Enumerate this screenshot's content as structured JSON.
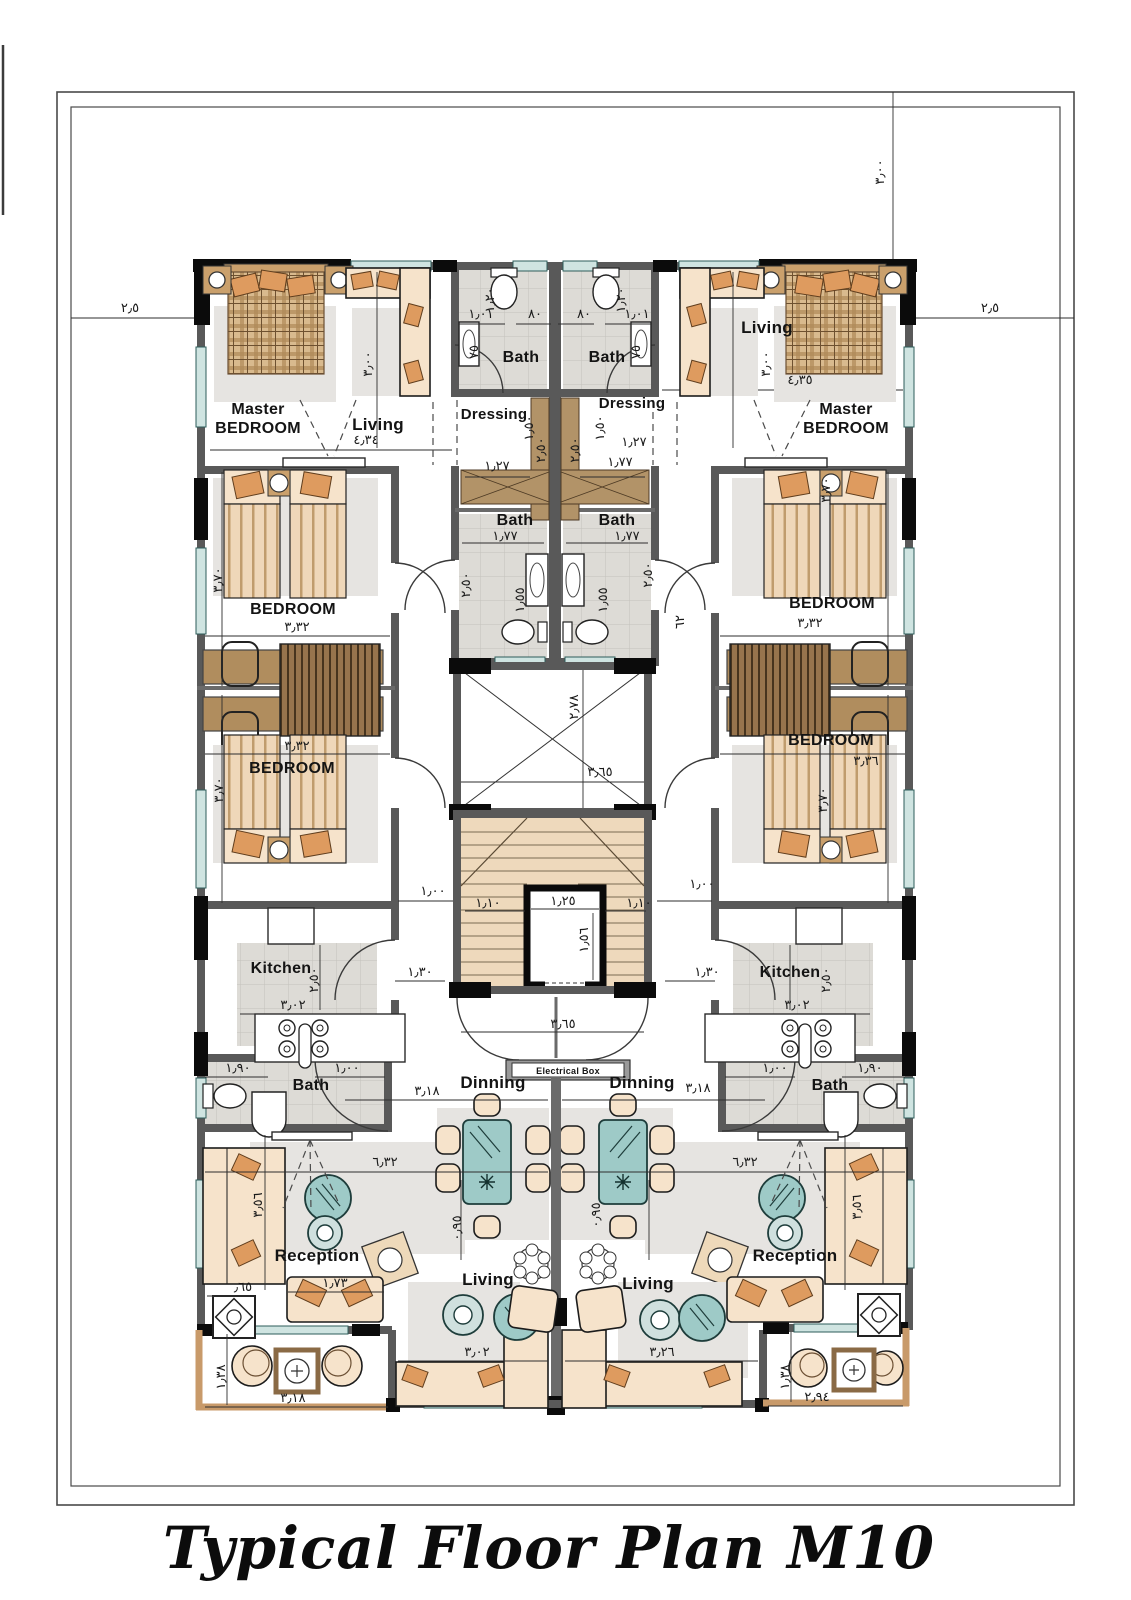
{
  "plan": {
    "title": "Typical Floor Plan M10",
    "colors": {
      "wall": "#595959",
      "column": "#0b0b0b",
      "window": "#cfe4e1",
      "furniture": "#f6e3cb",
      "cushion": "#de9b5f",
      "wood": "#b29368",
      "stair": "#eed9bc",
      "glass": "#9ecac7",
      "tile": "#dddbd6"
    },
    "room_labels": [
      {
        "id": "master-left-line1",
        "t": "Master",
        "x": 258,
        "y": 414,
        "s": 16
      },
      {
        "id": "master-left-line2",
        "t": "BEDROOM",
        "x": 258,
        "y": 433,
        "s": 16
      },
      {
        "id": "living-top-left",
        "t": "Living",
        "x": 378,
        "y": 430,
        "s": 17
      },
      {
        "id": "bath-top-left",
        "t": "Bath",
        "x": 521,
        "y": 362,
        "s": 16
      },
      {
        "id": "bath-top-right",
        "t": "Bath",
        "x": 607,
        "y": 362,
        "s": 16
      },
      {
        "id": "dressing-left",
        "t": "Dressing",
        "x": 494,
        "y": 419,
        "s": 15
      },
      {
        "id": "dressing-right",
        "t": "Dressing",
        "x": 632,
        "y": 408,
        "s": 15
      },
      {
        "id": "living-top-right",
        "t": "Living",
        "x": 767,
        "y": 333,
        "s": 17
      },
      {
        "id": "master-right-line1",
        "t": "Master",
        "x": 846,
        "y": 414,
        "s": 16
      },
      {
        "id": "master-right-line2",
        "t": "BEDROOM",
        "x": 846,
        "y": 433,
        "s": 16
      },
      {
        "id": "bath-mid-left",
        "t": "Bath",
        "x": 515,
        "y": 525,
        "s": 16
      },
      {
        "id": "bath-mid-right",
        "t": "Bath",
        "x": 617,
        "y": 525,
        "s": 16
      },
      {
        "id": "bedroom-left-1",
        "t": "BEDROOM",
        "x": 293,
        "y": 614,
        "s": 16
      },
      {
        "id": "bedroom-right-1",
        "t": "BEDROOM",
        "x": 832,
        "y": 608,
        "s": 16
      },
      {
        "id": "bedroom-left-2",
        "t": "BEDROOM",
        "x": 292,
        "y": 773,
        "s": 16
      },
      {
        "id": "bedroom-right-2",
        "t": "BEDROOM",
        "x": 831,
        "y": 745,
        "s": 16
      },
      {
        "id": "kitchen-left",
        "t": "Kitchen",
        "x": 281,
        "y": 973,
        "s": 16
      },
      {
        "id": "kitchen-right",
        "t": "Kitchen",
        "x": 790,
        "y": 977,
        "s": 16
      },
      {
        "id": "bath-bottom-left",
        "t": "Bath",
        "x": 311,
        "y": 1090,
        "s": 16
      },
      {
        "id": "bath-bottom-right",
        "t": "Bath",
        "x": 830,
        "y": 1090,
        "s": 16
      },
      {
        "id": "dinning-left",
        "t": "Dinning",
        "x": 493,
        "y": 1088,
        "s": 17
      },
      {
        "id": "dinning-right",
        "t": "Dinning",
        "x": 642,
        "y": 1088,
        "s": 17
      },
      {
        "id": "reception-left",
        "t": "Reception",
        "x": 317,
        "y": 1261,
        "s": 17
      },
      {
        "id": "reception-right",
        "t": "Reception",
        "x": 795,
        "y": 1261,
        "s": 17
      },
      {
        "id": "living-bottom-left",
        "t": "Living",
        "x": 488,
        "y": 1285,
        "s": 17
      },
      {
        "id": "living-bottom-right",
        "t": "Living",
        "x": 648,
        "y": 1289,
        "s": 17
      },
      {
        "id": "electrical-box",
        "t": "Electrical Box",
        "x": 568,
        "y": 1074,
        "s": 9
      }
    ],
    "dimensions": [
      {
        "t": "٢٫٥",
        "x": 130,
        "y": 312,
        "r": 0
      },
      {
        "t": "٢٫٥",
        "x": 990,
        "y": 312,
        "r": 0
      },
      {
        "t": "٣٫٠٠",
        "x": 884,
        "y": 172,
        "r": -90
      },
      {
        "t": "٤٫٣٤",
        "x": 366,
        "y": 444,
        "r": 0
      },
      {
        "t": "٤٫٣٥",
        "x": 800,
        "y": 384,
        "r": 0
      },
      {
        "t": "٣٫٠٠",
        "x": 372,
        "y": 364,
        "r": -90
      },
      {
        "t": "٣٫٠٠",
        "x": 770,
        "y": 364,
        "r": -90
      },
      {
        "t": "١٫٠١",
        "x": 481,
        "y": 318,
        "r": 0
      },
      {
        "t": "٨٠",
        "x": 535,
        "y": 318,
        "r": 0
      },
      {
        "t": "٨٠",
        "x": 584,
        "y": 318,
        "r": 0
      },
      {
        "t": "١٫٠١",
        "x": 637,
        "y": 318,
        "r": 0
      },
      {
        "t": "١٫٢٠",
        "x": 494,
        "y": 300,
        "r": -90
      },
      {
        "t": "١٫٢٠",
        "x": 625,
        "y": 300,
        "r": -90
      },
      {
        "t": "٧٥",
        "x": 478,
        "y": 352,
        "r": -90
      },
      {
        "t": "٧٥",
        "x": 640,
        "y": 352,
        "r": -90
      },
      {
        "t": "١٫٢٧",
        "x": 497,
        "y": 470,
        "r": 0
      },
      {
        "t": "١٫٢٧",
        "x": 634,
        "y": 446,
        "r": 0
      },
      {
        "t": "١٫٧٧",
        "x": 620,
        "y": 466,
        "r": 0
      },
      {
        "t": "١٫٥٠",
        "x": 533,
        "y": 428,
        "r": -90
      },
      {
        "t": "١٫٥٠",
        "x": 604,
        "y": 428,
        "r": -90
      },
      {
        "t": "٢٫٥٠",
        "x": 545,
        "y": 450,
        "r": -90
      },
      {
        "t": "٢٫٥٠",
        "x": 579,
        "y": 450,
        "r": -90
      },
      {
        "t": "١٫٧٧",
        "x": 505,
        "y": 540,
        "r": 0
      },
      {
        "t": "١٫٧٧",
        "x": 627,
        "y": 540,
        "r": 0
      },
      {
        "t": "١٫٥٥",
        "x": 524,
        "y": 600,
        "r": -90
      },
      {
        "t": "١٫٥٥",
        "x": 607,
        "y": 600,
        "r": -90
      },
      {
        "t": "٢٫٥٠",
        "x": 470,
        "y": 585,
        "r": -90
      },
      {
        "t": "٢٫٥٠",
        "x": 652,
        "y": 575,
        "r": -90
      },
      {
        "t": "٦٢",
        "x": 684,
        "y": 622,
        "r": -90
      },
      {
        "t": "٣٫٧٠",
        "x": 222,
        "y": 580,
        "r": -90
      },
      {
        "t": "٣٫٧٠",
        "x": 830,
        "y": 490,
        "r": -90
      },
      {
        "t": "٣٫٣٢",
        "x": 297,
        "y": 631,
        "r": 0
      },
      {
        "t": "٣٫٣٢",
        "x": 810,
        "y": 627,
        "r": 0
      },
      {
        "t": "٣٫٧٠",
        "x": 223,
        "y": 790,
        "r": -90
      },
      {
        "t": "٣٫٧٠",
        "x": 827,
        "y": 800,
        "r": -90
      },
      {
        "t": "٣٫٣٢",
        "x": 297,
        "y": 750,
        "r": 0
      },
      {
        "t": "٣٫٣٦",
        "x": 866,
        "y": 765,
        "r": 0
      },
      {
        "t": "٢٫٧٨",
        "x": 578,
        "y": 707,
        "r": -90
      },
      {
        "t": "٣٫٦٥",
        "x": 600,
        "y": 776,
        "r": 0
      },
      {
        "t": "١٫٠٠",
        "x": 433,
        "y": 895,
        "r": 0
      },
      {
        "t": "١٫٠٠",
        "x": 702,
        "y": 888,
        "r": 0
      },
      {
        "t": "١٫١٠",
        "x": 488,
        "y": 907,
        "r": 0
      },
      {
        "t": "١٫١٠",
        "x": 639,
        "y": 907,
        "r": 0
      },
      {
        "t": "١٫٢٥",
        "x": 563,
        "y": 905,
        "r": 0
      },
      {
        "t": "١٫٥٦",
        "x": 588,
        "y": 940,
        "r": -90
      },
      {
        "t": "٣٫٦٥",
        "x": 563,
        "y": 1028,
        "r": 0
      },
      {
        "t": "١٫٣٠",
        "x": 420,
        "y": 976,
        "r": 0
      },
      {
        "t": "١٫٣٠",
        "x": 707,
        "y": 976,
        "r": 0
      },
      {
        "t": "٣٫٠٢",
        "x": 293,
        "y": 1009,
        "r": 0
      },
      {
        "t": "٣٫٠٢",
        "x": 797,
        "y": 1009,
        "r": 0
      },
      {
        "t": "٢٫٥٠",
        "x": 318,
        "y": 980,
        "r": -90
      },
      {
        "t": "٢٫٥٠",
        "x": 830,
        "y": 980,
        "r": -90
      },
      {
        "t": "١٫٩٠",
        "x": 238,
        "y": 1072,
        "r": 0
      },
      {
        "t": "١٫٩٠",
        "x": 870,
        "y": 1072,
        "r": 0
      },
      {
        "t": "١٫٠٠",
        "x": 347,
        "y": 1072,
        "r": 0
      },
      {
        "t": "١٫٠٠",
        "x": 775,
        "y": 1072,
        "r": 0
      },
      {
        "t": "٣٫١٨",
        "x": 427,
        "y": 1095,
        "r": 0
      },
      {
        "t": "٣٫١٨",
        "x": 698,
        "y": 1092,
        "r": 0
      },
      {
        "t": "٦٫٣٢",
        "x": 385,
        "y": 1166,
        "r": 0
      },
      {
        "t": "٦٫٣٢",
        "x": 745,
        "y": 1166,
        "r": 0
      },
      {
        "t": "٣٫٥٦",
        "x": 262,
        "y": 1205,
        "r": -90
      },
      {
        "t": "٣٫٥٦",
        "x": 861,
        "y": 1207,
        "r": -90
      },
      {
        "t": "٠٫٩٥",
        "x": 461,
        "y": 1228,
        "r": -90
      },
      {
        "t": "٠٫٩٥",
        "x": 600,
        "y": 1215,
        "r": -90
      },
      {
        "t": "١٫٧٣",
        "x": 335,
        "y": 1287,
        "r": 0
      },
      {
        "t": "٫٦٥",
        "x": 243,
        "y": 1291,
        "r": 0
      },
      {
        "t": "٣٫٠٢",
        "x": 477,
        "y": 1356,
        "r": 0
      },
      {
        "t": "٣٫٢٦",
        "x": 662,
        "y": 1356,
        "r": 0
      },
      {
        "t": "١٫٣٨",
        "x": 225,
        "y": 1377,
        "r": -90
      },
      {
        "t": "١٫٣٨",
        "x": 789,
        "y": 1377,
        "r": -90
      },
      {
        "t": "٣٫١٨",
        "x": 293,
        "y": 1402,
        "r": 0
      },
      {
        "t": "٢٫٩٤",
        "x": 817,
        "y": 1401,
        "r": 0
      }
    ]
  }
}
